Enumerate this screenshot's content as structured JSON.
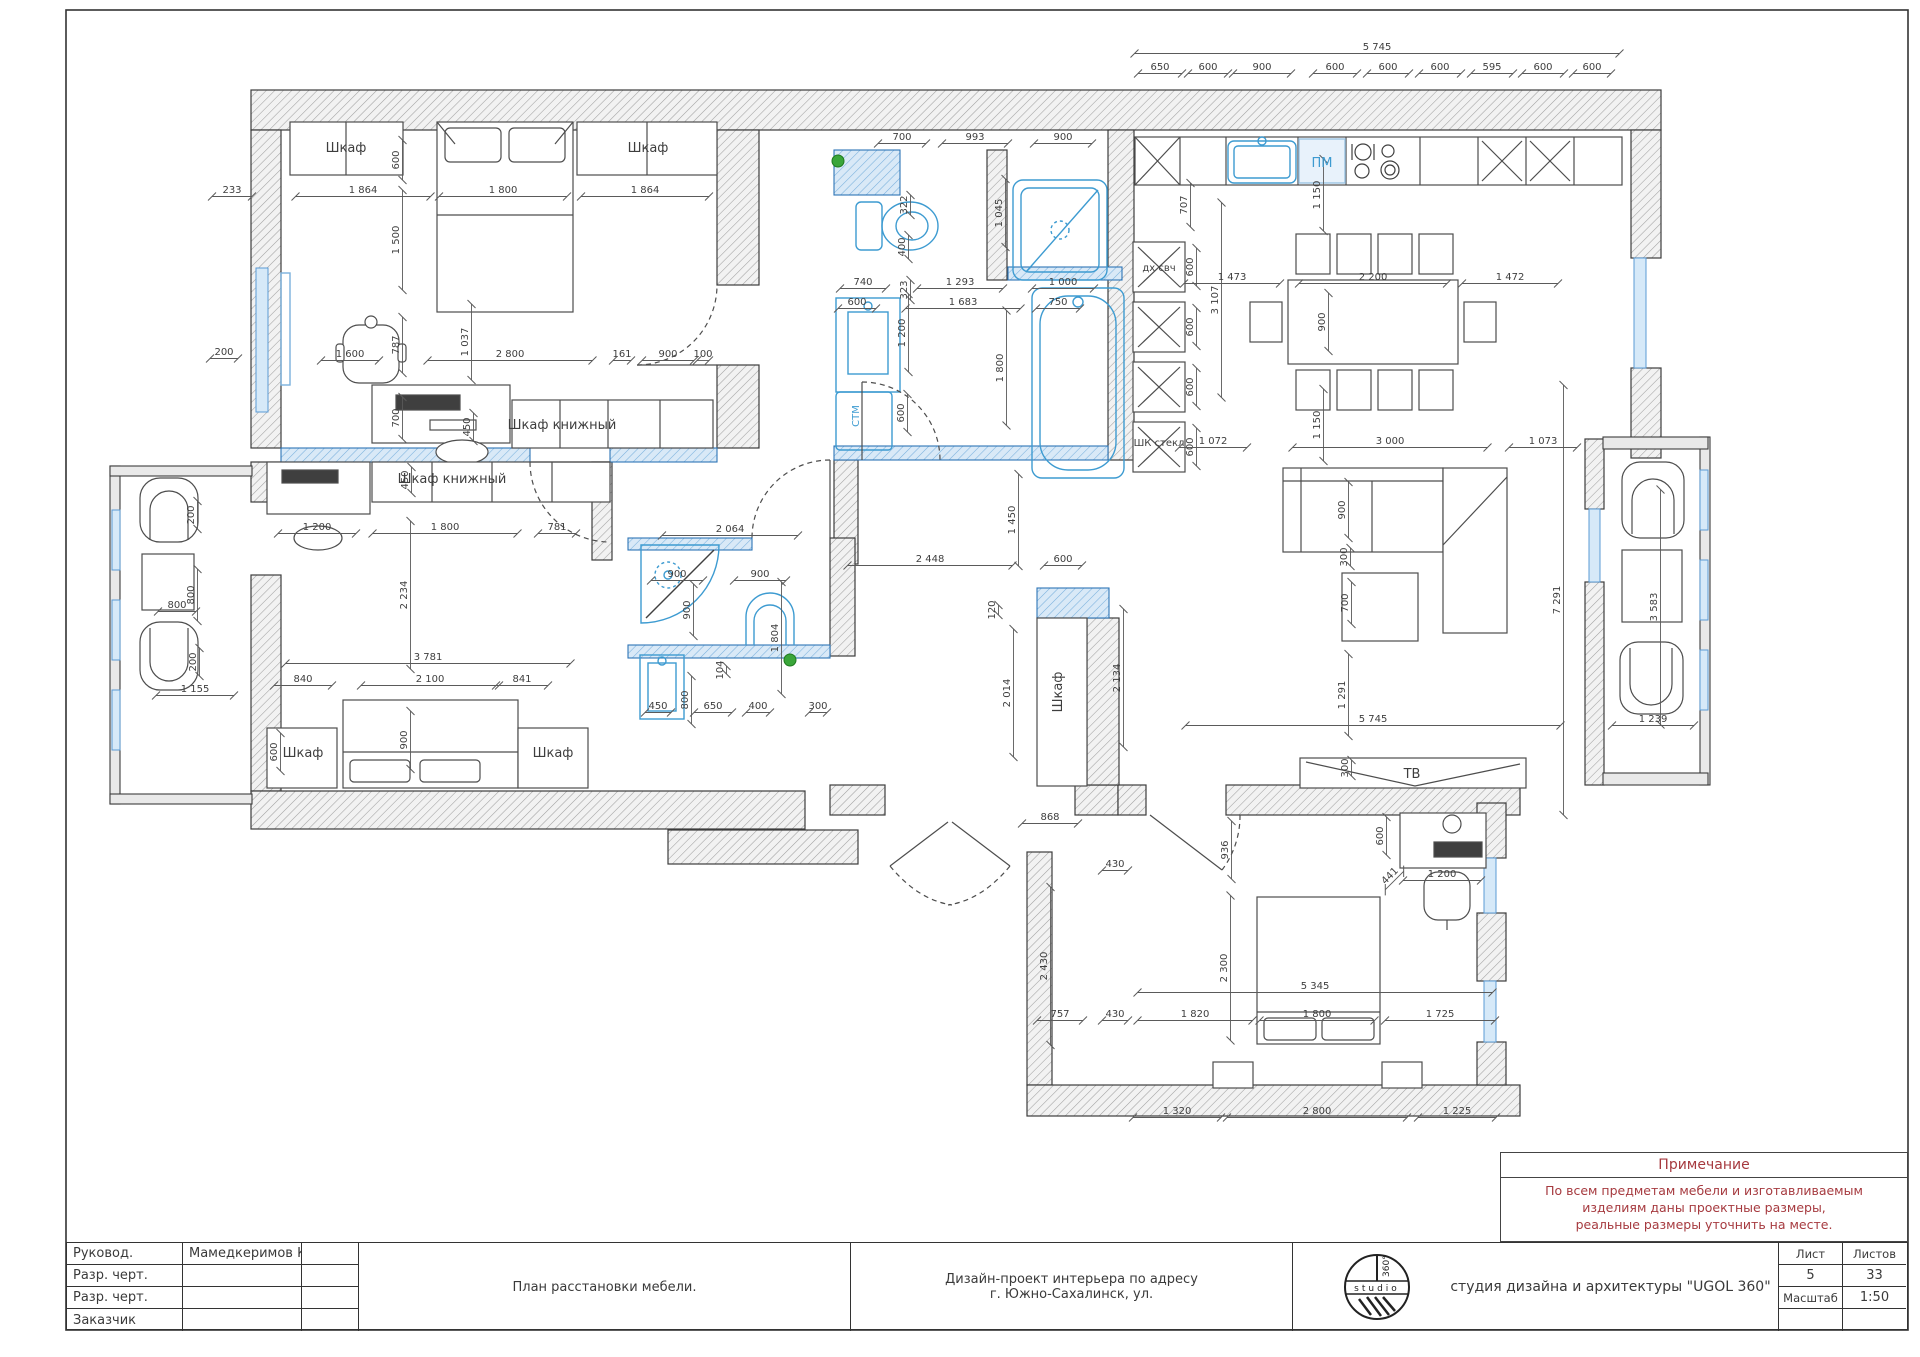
{
  "note": {
    "title": "Примечание",
    "lines": [
      "По всем предметам мебели и изготавливаемым",
      "изделиям даны проектные размеры,",
      "реальные размеры уточнить на месте."
    ]
  },
  "title_block": {
    "rows": [
      {
        "label": "Руковод.",
        "value": "Мамедкеримов К.Р."
      },
      {
        "label": "Разр. черт.",
        "value": ""
      },
      {
        "label": "Разр. черт.",
        "value": ""
      },
      {
        "label": "Заказчик",
        "value": ""
      }
    ],
    "drawing_title": "План расстановки мебели.",
    "project_line1": "Дизайн-проект интерьера по адресу",
    "project_line2": "г. Южно-Сахалинск, ул.",
    "studio": "студия дизайна и архитектуры \"UGOL 360\"",
    "logo": {
      "band": "studio",
      "degrees": "360°"
    },
    "sheet_label": "Лист",
    "sheet_value": "5",
    "sheets_label": "Листов",
    "sheets_value": "33",
    "scale_label": "Масштаб",
    "scale_value": "1:50"
  },
  "colors": {
    "fixture_blue": "#3d9bd1",
    "wall_blue": "#7ab1dd",
    "note_red": "#a63a3f",
    "marker_green": "#3aa63a"
  },
  "plan": {
    "labels": [
      {
        "t": "Шкаф",
        "x": 346,
        "y": 152
      },
      {
        "t": "Шкаф",
        "x": 648,
        "y": 152
      },
      {
        "t": "Шкаф книжный",
        "x": 562,
        "y": 429
      },
      {
        "t": "Шкаф книжный",
        "x": 452,
        "y": 483
      },
      {
        "t": "Шкаф",
        "x": 303,
        "y": 757
      },
      {
        "t": "Шкаф",
        "x": 553,
        "y": 757
      },
      {
        "t": "Шкаф",
        "x": 1062,
        "y": 692,
        "r": -90
      },
      {
        "t": "ТВ",
        "x": 1412,
        "y": 778
      },
      {
        "t": "ПМ",
        "x": 1322,
        "y": 167,
        "c": "blue"
      },
      {
        "t": "дх свч",
        "x": 1159,
        "y": 271,
        "s": 10
      },
      {
        "t": "ШК стекл",
        "x": 1159,
        "y": 446,
        "s": 10
      },
      {
        "t": "СТМ",
        "x": 859,
        "y": 416,
        "r": -90,
        "c": "blue",
        "s": 10
      }
    ],
    "dims": [
      {
        "t": "5 745",
        "x": 1377,
        "y": 50,
        "l": 485
      },
      {
        "t": "650",
        "x": 1160,
        "y": 70,
        "l": 44
      },
      {
        "t": "600",
        "x": 1208,
        "y": 70,
        "l": 40
      },
      {
        "t": "900",
        "x": 1262,
        "y": 70,
        "l": 58
      },
      {
        "t": "600",
        "x": 1335,
        "y": 70,
        "l": 44
      },
      {
        "t": "600",
        "x": 1388,
        "y": 70,
        "l": 42
      },
      {
        "t": "600",
        "x": 1440,
        "y": 70,
        "l": 42
      },
      {
        "t": "595",
        "x": 1492,
        "y": 70,
        "l": 42
      },
      {
        "t": "600",
        "x": 1543,
        "y": 70,
        "l": 42
      },
      {
        "t": "600",
        "x": 1592,
        "y": 70,
        "l": 38
      },
      {
        "t": "233",
        "x": 232,
        "y": 193,
        "l": 40
      },
      {
        "t": "1 864",
        "x": 363,
        "y": 193,
        "l": 135
      },
      {
        "t": "1 800",
        "x": 503,
        "y": 193,
        "l": 128
      },
      {
        "t": "1 864",
        "x": 645,
        "y": 193,
        "l": 128
      },
      {
        "t": "600",
        "x": 399,
        "y": 160,
        "r": -90,
        "l": 40
      },
      {
        "t": "1 500",
        "x": 399,
        "y": 240,
        "r": -90,
        "l": 100
      },
      {
        "t": "787",
        "x": 399,
        "y": 345,
        "r": -90,
        "l": 56
      },
      {
        "t": "1 037",
        "x": 468,
        "y": 342,
        "r": -90,
        "l": 76
      },
      {
        "t": "700",
        "x": 399,
        "y": 418,
        "r": -90,
        "l": 42
      },
      {
        "t": "450",
        "x": 470,
        "y": 427,
        "r": -90,
        "l": 28
      },
      {
        "t": "200",
        "x": 224,
        "y": 355,
        "l": 28
      },
      {
        "t": "1 600",
        "x": 350,
        "y": 357,
        "l": 58
      },
      {
        "t": "2 800",
        "x": 510,
        "y": 357,
        "l": 165
      },
      {
        "t": "161",
        "x": 622,
        "y": 357,
        "l": 18
      },
      {
        "t": "900",
        "x": 668,
        "y": 357,
        "l": 52
      },
      {
        "t": "100",
        "x": 703,
        "y": 357,
        "l": 12
      },
      {
        "t": "450",
        "x": 408,
        "y": 480,
        "r": -90,
        "l": 26
      },
      {
        "t": "1 200",
        "x": 317,
        "y": 530,
        "l": 78
      },
      {
        "t": "1 800",
        "x": 445,
        "y": 530,
        "l": 145
      },
      {
        "t": "781",
        "x": 557,
        "y": 530,
        "l": 38
      },
      {
        "t": "2 234",
        "x": 407,
        "y": 595,
        "r": -90,
        "l": 148
      },
      {
        "t": "3 781",
        "x": 428,
        "y": 660,
        "l": 285
      },
      {
        "t": "840",
        "x": 303,
        "y": 682,
        "l": 58
      },
      {
        "t": "2 100",
        "x": 430,
        "y": 682,
        "l": 138
      },
      {
        "t": "841",
        "x": 522,
        "y": 682,
        "l": 52
      },
      {
        "t": "600",
        "x": 277,
        "y": 752,
        "r": -90,
        "l": 38
      },
      {
        "t": "900",
        "x": 407,
        "y": 740,
        "r": -90,
        "l": 58
      },
      {
        "t": "1 155",
        "x": 195,
        "y": 692,
        "l": 78
      },
      {
        "t": "200",
        "x": 194,
        "y": 515,
        "r": -90,
        "l": 28
      },
      {
        "t": "800",
        "x": 194,
        "y": 595,
        "r": -90,
        "l": 52
      },
      {
        "t": "800",
        "x": 177,
        "y": 608,
        "l": 38
      },
      {
        "t": "200",
        "x": 196,
        "y": 662,
        "r": -90,
        "l": 28
      },
      {
        "t": "700",
        "x": 902,
        "y": 140,
        "l": 48
      },
      {
        "t": "993",
        "x": 975,
        "y": 140,
        "l": 66
      },
      {
        "t": "900",
        "x": 1063,
        "y": 140,
        "l": 58
      },
      {
        "t": "322",
        "x": 907,
        "y": 205,
        "r": -90,
        "l": 20
      },
      {
        "t": "400",
        "x": 905,
        "y": 247,
        "r": -90,
        "l": 24
      },
      {
        "t": "323",
        "x": 907,
        "y": 290,
        "r": -90,
        "l": 20
      },
      {
        "t": "1 045",
        "x": 1002,
        "y": 213,
        "r": -90,
        "l": 68
      },
      {
        "t": "740",
        "x": 863,
        "y": 285,
        "l": 46
      },
      {
        "t": "1 293",
        "x": 960,
        "y": 285,
        "l": 86
      },
      {
        "t": "1 000",
        "x": 1063,
        "y": 285,
        "l": 62
      },
      {
        "t": "600",
        "x": 857,
        "y": 305,
        "l": 38
      },
      {
        "t": "1 683",
        "x": 963,
        "y": 305,
        "l": 115
      },
      {
        "t": "750",
        "x": 1058,
        "y": 305,
        "l": 44
      },
      {
        "t": "1 200",
        "x": 905,
        "y": 333,
        "r": -90,
        "l": 78
      },
      {
        "t": "1 800",
        "x": 1003,
        "y": 368,
        "r": -90,
        "l": 115
      },
      {
        "t": "600",
        "x": 904,
        "y": 413,
        "r": -90,
        "l": 38
      },
      {
        "t": "707",
        "x": 1187,
        "y": 205,
        "r": -90,
        "l": 44
      },
      {
        "t": "3 107",
        "x": 1218,
        "y": 300,
        "r": -90,
        "l": 195
      },
      {
        "t": "600",
        "x": 1193,
        "y": 267,
        "r": -90,
        "l": 38
      },
      {
        "t": "600",
        "x": 1193,
        "y": 327,
        "r": -90,
        "l": 38
      },
      {
        "t": "600",
        "x": 1193,
        "y": 387,
        "r": -90,
        "l": 38
      },
      {
        "t": "600",
        "x": 1193,
        "y": 447,
        "r": -90,
        "l": 38
      },
      {
        "t": "1 473",
        "x": 1232,
        "y": 280,
        "l": 96
      },
      {
        "t": "2 200",
        "x": 1373,
        "y": 280,
        "l": 148
      },
      {
        "t": "1 472",
        "x": 1510,
        "y": 280,
        "l": 96
      },
      {
        "t": "1 150",
        "x": 1320,
        "y": 195,
        "r": -90,
        "l": 72
      },
      {
        "t": "900",
        "x": 1325,
        "y": 322,
        "r": -90,
        "l": 58
      },
      {
        "t": "1 150",
        "x": 1320,
        "y": 425,
        "r": -90,
        "l": 72
      },
      {
        "t": "1 072",
        "x": 1213,
        "y": 444,
        "l": 68
      },
      {
        "t": "3 000",
        "x": 1390,
        "y": 444,
        "l": 195
      },
      {
        "t": "1 073",
        "x": 1543,
        "y": 444,
        "l": 68
      },
      {
        "t": "7 291",
        "x": 1560,
        "y": 600,
        "r": -90,
        "l": 430
      },
      {
        "t": "900",
        "x": 1345,
        "y": 510,
        "r": -90,
        "l": 56
      },
      {
        "t": "300",
        "x": 1347,
        "y": 557,
        "r": -90,
        "l": 18
      },
      {
        "t": "700",
        "x": 1348,
        "y": 603,
        "r": -90,
        "l": 42
      },
      {
        "t": "1 291",
        "x": 1345,
        "y": 695,
        "r": -90,
        "l": 82
      },
      {
        "t": "5 745",
        "x": 1373,
        "y": 722,
        "l": 375
      },
      {
        "t": "300",
        "x": 1348,
        "y": 768,
        "r": -90,
        "l": 16
      },
      {
        "t": "3 583",
        "x": 1657,
        "y": 607,
        "r": -90,
        "l": 235
      },
      {
        "t": "1 239",
        "x": 1653,
        "y": 722,
        "l": 82
      },
      {
        "t": "2 448",
        "x": 930,
        "y": 562,
        "l": 165
      },
      {
        "t": "1 450",
        "x": 1015,
        "y": 520,
        "r": -90,
        "l": 92
      },
      {
        "t": "600",
        "x": 1063,
        "y": 562,
        "l": 38
      },
      {
        "t": "120",
        "x": 995,
        "y": 610,
        "r": -90,
        "l": 10
      },
      {
        "t": "2 014",
        "x": 1010,
        "y": 693,
        "r": -90,
        "l": 128
      },
      {
        "t": "2 134",
        "x": 1120,
        "y": 678,
        "r": -90,
        "l": 138
      },
      {
        "t": "868",
        "x": 1050,
        "y": 820,
        "l": 56
      },
      {
        "t": "2 064",
        "x": 730,
        "y": 532,
        "l": 136
      },
      {
        "t": "900",
        "x": 677,
        "y": 577,
        "l": 52
      },
      {
        "t": "900",
        "x": 760,
        "y": 577,
        "l": 52
      },
      {
        "t": "900",
        "x": 690,
        "y": 610,
        "r": -90,
        "l": 52
      },
      {
        "t": "1 804",
        "x": 778,
        "y": 638,
        "r": -90,
        "l": 112
      },
      {
        "t": "104",
        "x": 723,
        "y": 670,
        "r": -90,
        "l": 8
      },
      {
        "t": "800",
        "x": 688,
        "y": 700,
        "r": -90,
        "l": 48
      },
      {
        "t": "450",
        "x": 658,
        "y": 709,
        "l": 26
      },
      {
        "t": "650",
        "x": 713,
        "y": 709,
        "l": 38
      },
      {
        "t": "400",
        "x": 758,
        "y": 709,
        "l": 24
      },
      {
        "t": "300",
        "x": 818,
        "y": 709,
        "l": 18
      },
      {
        "t": "430",
        "x": 1115,
        "y": 867,
        "l": 26
      },
      {
        "t": "936",
        "x": 1228,
        "y": 850,
        "r": -90,
        "l": 58
      },
      {
        "t": "600",
        "x": 1383,
        "y": 836,
        "r": -90,
        "l": 38
      },
      {
        "t": "441",
        "x": 1392,
        "y": 878,
        "r": -45,
        "l": 26
      },
      {
        "t": "1 200",
        "x": 1442,
        "y": 877,
        "l": 78
      },
      {
        "t": "2 300",
        "x": 1227,
        "y": 968,
        "r": -90,
        "l": 145
      },
      {
        "t": "5 345",
        "x": 1315,
        "y": 989,
        "l": 355
      },
      {
        "t": "2 430",
        "x": 1047,
        "y": 966,
        "r": -90,
        "l": 158
      },
      {
        "t": "757",
        "x": 1060,
        "y": 1017,
        "l": 46
      },
      {
        "t": "430",
        "x": 1115,
        "y": 1017,
        "l": 26
      },
      {
        "t": "1 820",
        "x": 1195,
        "y": 1017,
        "l": 115
      },
      {
        "t": "1 800",
        "x": 1317,
        "y": 1017,
        "l": 115
      },
      {
        "t": "1 725",
        "x": 1440,
        "y": 1017,
        "l": 110
      },
      {
        "t": "1 320",
        "x": 1177,
        "y": 1114,
        "l": 88
      },
      {
        "t": "2 800",
        "x": 1317,
        "y": 1114,
        "l": 180
      },
      {
        "t": "1 225",
        "x": 1457,
        "y": 1114,
        "l": 78
      }
    ]
  }
}
